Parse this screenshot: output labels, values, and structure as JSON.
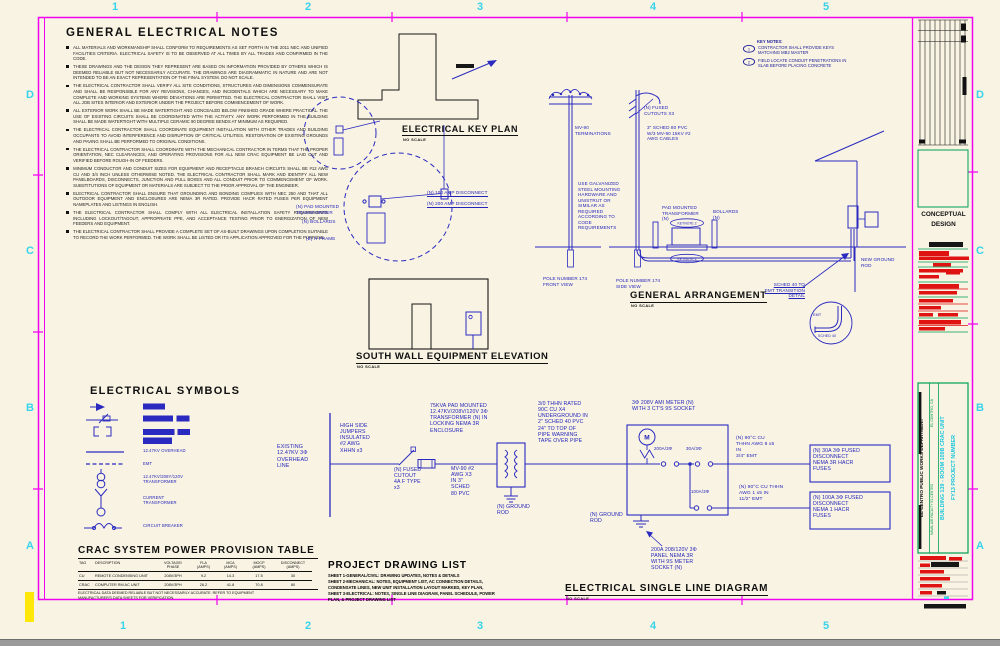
{
  "sheet": {
    "grid_cols": [
      "1",
      "2",
      "3",
      "4",
      "5"
    ],
    "grid_rows": [
      "D",
      "C",
      "B",
      "A"
    ]
  },
  "general_notes": {
    "title": "GENERAL ELECTRICAL NOTES",
    "items": [
      "ALL MATERIALS AND WORKMANSHIP SHALL CONFORM TO REQUIREMENTS AS SET FORTH IN THE 2011 NEC AND UNIFIED FACILITIES CRITERIA. ELECTRICAL SAFETY IS TO BE OBSERVED AT ALL TIMES BY ALL TRADES AND CONFIRMED IN THE CODE.",
      "THESE DRAWINGS AND THE DESIGN THEY REPRESENT ARE BASED ON INFORMATION PROVIDED BY OTHERS WHICH IS DEEMED RELIABLE BUT NOT NECESSARILY ACCURATE. THE DRAWINGS ARE DIAGRAMMATIC IN NATURE AND ARE NOT INTENDED TO BE AN EXACT REPRESENTATION OF THE FINAL SYSTEM. DO NOT SCALE.",
      "THE ELECTRICAL CONTRACTOR SHALL VERIFY ALL SITE CONDITIONS, STRUCTURES AND DIMENSIONS COMMENSURATE AND SHALL BE RESPONSIBLE FOR ANY REVISIONS, CHANGES, AND INCIDENTALS WHICH ARE NECESSARY TO MAKE COMPLETE AND WORKING SYSTEMS WHERE DEVIATIONS ARE PERMITTED. THE ELECTRICAL CONTRACTOR SHALL VISIT ALL JOB SITES INTERIOR AND EXTERIOR UNDER THE PROJECT BEFORE COMMENCEMENT OF WORK.",
      "ALL EXTERIOR WORK SHALL BE MADE WATERTIGHT AND CONCEALED BELOW FINISHED GRADE WHERE PRACTICAL. THE USE OF EXISTING CIRCUITS SHALL BE COORDINATED WITH THE ACTIVITY. ANY WORK PERFORMED IN THE BUILDING SHALL BE MADE WATERTIGHT WITH MULTIPLE CERAMIC 90 DEGREE BENDS AT MINIMUM AS REQUIRED.",
      "THE ELECTRICAL CONTRACTOR SHALL COORDINATE EQUIPMENT INSTALLATION WITH OTHER TRADES AND BUILDING OCCUPANTS TO AVOID INTERFERENCE AND DISRUPTION OF CRITICAL UTILITIES. RESTORATION OF EXISTING GROUNDS AND PAVING SHALL BE PERFORMED TO ORIGINAL CONDITIONS.",
      "THE ELECTRICAL CONTRACTOR SHALL COORDINATE WITH THE MECHANICAL CONTRACTOR IN TERMS THAT THE PROPER ORIENTATION, NEC CLEARANCES, AND OPERATING PROVISIONS FOR ALL NEW CRAC EQUIPMENT BE LAID OUT AND VERIFIED BEFORE ROUGH-IN OF FEEDERS.",
      "MINIMUM CONDUCTOR AND CONDUIT SIZES FOR EQUIPMENT AND RECEPTACLE BRANCH CIRCUITS SHALL BE #12 AWG CU AND 3/4 INCH UNLESS OTHERWISE NOTED. THE ELECTRICAL CONTRACTOR SHALL MARK AND IDENTIFY ALL NEW PANELBOARDS, DISCONNECTS, JUNCTION AND PULL BOXES AND ALL CONDUIT PRIOR TO COMMENCEMENT OF WORK. SUBSTITUTIONS OF EQUIPMENT OR MATERIALS ARE SUBJECT TO THE PRIOR APPROVAL OF THE ENGINEER.",
      "ELECTRICAL CONTRACTOR SHALL ENSURE THAT GROUNDING AND BONDING COMPLIES WITH NEC 250 AND THAT ALL OUTDOOR EQUIPMENT AND ENCLOSURES ARE NEMA 3R RATED. PROVIDE HACR RATED FUSES PER EQUIPMENT NAMEPLATES AND LISTINGS IN ENGLISH.",
      "THE ELECTRICAL CONTRACTOR SHALL COMPLY WITH ALL ELECTRICAL INSTALLATION SAFETY REQUIREMENTS INCLUDING LOCKOUT/TAGOUT, APPROPRIATE PPE, AND ACCEPTANCE TESTING PRIOR TO ENERGIZATION OF NEW FEEDERS AND EQUIPMENT.",
      "THE ELECTRICAL CONTRACTOR SHALL PROVIDE A COMPLETE SET OF AS-BUILT DRAWINGS UPON COMPLETION SUITABLE TO RECORD THE WORK PERFORMED. THE WORK SHALL BE LISTED OR ITS APPLICATION APPROVED FOR THE PURPOSE."
    ]
  },
  "key_notes": {
    "title": "KEY NOTES:",
    "items": [
      {
        "num": "1",
        "text": "CONTRACTOR SHALL PROVIDE KEYS\nMATCHING MB2 MASTER"
      },
      {
        "num": "2",
        "text": "FIELD LOCATE CONDUIT PENETRATIONS IN\nSLAB BEFORE PLACING CONCRETE"
      }
    ]
  },
  "key_plan": {
    "title": "ELECTRICAL KEY PLAN",
    "scale": "NO SCALE",
    "labels": {
      "transformer": "(N) PAD MOUNTED\nTRANSFORMER",
      "bollards": "(N) BOLLARDS",
      "h_frame": "(E) H FRAME",
      "disconnect_100": "(N) 100 AMP DISCONNECT",
      "disconnect_200": "(N) 200 AMP DISCONNECT"
    }
  },
  "general_arrangement": {
    "title": "GENERAL ARRANGEMENT",
    "scale": "NO SCALE",
    "labels": {
      "mv90": "MV-90\nTERMINATIONS",
      "cutouts": "(N) FUSED\nCUTOUTS X3",
      "pvc": "3\" SCHED 80 PVC\nW/3 MV-90 15KV #2\nAWG CABLES",
      "hardware": "USE GALVANIZED\nSTEEL MOUNTING\nHARDWARE AND\nUNISTRUT OR\nSIMILAR AS\nREQUIRED\nACCORDING TO\nCODE\nREQUIREMENTS",
      "pad_transformer": "PAD MOUNTED\nTRANSFORMER\n(N)",
      "bollards": "BOLLARDS\n(N)",
      "keynote_top": "KEYNOTE 2",
      "keynote_bottom": "KEYNOTE 2",
      "pole_front": "POLE NUMBER 174\nFRONT VIEW",
      "pole_side": "POLE NUMBER 174\nSIDE VIEW",
      "ground_rod": "NEW GROUND\nROD",
      "transition": "SCHED 40 TO\nEMT TRANSITION\nDETAIL",
      "emt": "EMT",
      "sched40": "SCHED 40"
    }
  },
  "south_wall": {
    "title": "SOUTH WALL EQUIPMENT ELEVATION",
    "scale": "NO SCALE"
  },
  "symbols": {
    "title": "ELECTRICAL SYMBOLS",
    "overhead": "12.47KV OVERHEAD",
    "emt": "EMT",
    "transformer": "12.47KV/208Y/120V\nTRANSFORMER",
    "current_transformer": "CURRENT\nTRANSFORMER",
    "circuit_breaker": "CIRCUIT BREAKER"
  },
  "crac_table": {
    "title": "CRAC SYSTEM POWER PROVISION TABLE",
    "headers": [
      "TAG",
      "DESCRIPTION",
      "VOLTAGE/\nPHASE",
      "FLA\n(AMPS)",
      "MCA\n(AMPS)",
      "MOCP\n(AMPS)",
      "DISCONNECT\n(AMPS)"
    ],
    "rows": [
      [
        "CU",
        "REMOTE CONDENSING UNIT",
        "208V/3PH",
        "9.2",
        "14.3",
        "17.5",
        "30"
      ],
      [
        "CRAC",
        "COMPUTER RM AC UNIT",
        "208V/3PH",
        "26.2",
        "41.8",
        "70.8",
        "80"
      ]
    ],
    "note": "ELECTRICAL DATA DEEMED RELIABLE BUT NOT NECESSARILY ACCURATE.  REFER TO EQUIPMENT\nMANUFACTURER'S DATA SHEETS FOR VERIFICATION."
  },
  "drawing_list": {
    "title": "PROJECT DRAWING LIST",
    "lines": [
      "SHEET 1-GENERAL/CIVIL: DRAWING UPDATES, NOTES & DETAILS",
      "SHEET 2-MECHANICAL: NOTES, EQUIPMENT LIST, AC CONNECTION DETAILS,",
      "CONDENSATE LINES, NEW UNIT INSTALLATION LAYOUT MARKED, KEY PLAN,",
      "SHEET 3-ELECTRICAL: NOTES, SINGLE LINE DIAGRAM, PANEL SCHEDULE, POWER",
      "PLAN, & PROJECT DRAWING LIST"
    ]
  },
  "single_line": {
    "title": "ELECTRICAL SINGLE LINE DIAGRAM",
    "scale": "NO SCALE",
    "labels": {
      "existing": "EXISTING\n12.47KV 3Φ\nOVERHEAD\nLINE",
      "jumpers": "HIGH SIDE\nJUMPERS\nINSULATED\n#2 AWG\nXHHN x3",
      "cutout": "(N) FUSED\nCUTOUT\n4A F TYPE\nx3",
      "transformer": "75KVA PAD MOUNTED\n12.47KV/208V/120V 3Φ\nTRANSFORMER (N) IN\nLOCKING NEMA 3R\nENCLOSURE",
      "mv90": "MV-90 #2\nAWG X3\nIN 3\"\nSCHED\n80 PVC",
      "underground": "3/0 THHN RATED\n90C CU X4\nUNDERGROUND IN\n2\" SCHED 40 PVC\n24\" TO TOP OF\nPIPE WARNING\nTAPE OVER PIPE",
      "ground_left": "(N) GROUND\nROD",
      "ground_right": "(N) GROUND\nROD",
      "meter": "3Φ 208V AMI METER (N)\nWITH 3 CT'S 9S SOCKET",
      "meter_letter": "M",
      "breaker_200": "200A/3Φ",
      "breaker_30": "30A/3Φ",
      "breaker_100": "100A/3Φ",
      "wire_30": "(N) 90°C CU\nTHHN AWG 8 x5\nIN\n3/4\" EMT",
      "wire_100": "(N) 90°C CU THHN\nAWG 1 x5 IN\n11/2\" EMT",
      "disc_30": "(N) 30A 3Φ FUSED\nDISCONNECT\nNEMA 3R HACR\nFUSES",
      "disc_100": "(N) 100A 3Φ FUSED\nDISCONNECT\nNEMA 1 HACR\nFUSES",
      "panel": "200A 208/120V 3Φ\nPANEL NEMA 3R\nWITH 9S METER\nSOCKET  (N)"
    }
  },
  "title_block": {
    "stage": "CONCEPTUAL\nDESIGN",
    "department": "EL CENTRO PUBLIC WORKS DEPARTMENT",
    "facility": "NAVAL AIR FACILITY EL CENTRO",
    "location": "EL CENTRO, CA",
    "project_line1": "BUILDING 139 - ROOM 109B CRAC UNIT",
    "project_line2": "FY13 PROJECT NUMBER"
  }
}
